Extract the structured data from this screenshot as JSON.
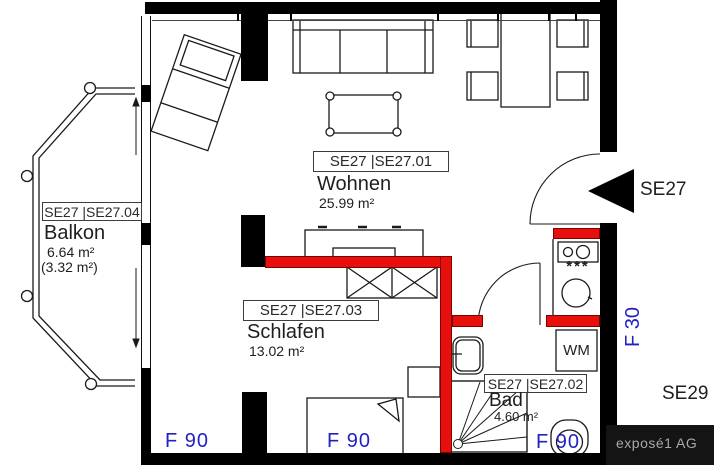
{
  "plan": {
    "rooms": {
      "wohnen": {
        "tag": "SE27 |SE27.01",
        "name": "Wohnen",
        "area": "25.99 m²"
      },
      "schlafen": {
        "tag": "SE27 |SE27.03",
        "name": "Schlafen",
        "area": "13.02 m²"
      },
      "bad": {
        "tag": "SE27 |SE27.02",
        "name": "Bad",
        "area": "4.60 m²"
      },
      "balkon": {
        "tag": "SE27 |SE27.04",
        "name": "Balkon",
        "area": "6.64 m²",
        "area_secondary": "(3.32 m²)"
      }
    },
    "markers": {
      "unit_label": "SE27",
      "neighbor_label": "SE29",
      "fire_rating_f90": "F 90",
      "fire_rating_f30": "F 30",
      "washing_machine": "WM",
      "cooktop_stars": "***"
    },
    "branding": {
      "logo_text": "exposé1 AG"
    },
    "colors": {
      "fire_wall": "#e8100c",
      "rating_text": "#2222c0"
    }
  }
}
